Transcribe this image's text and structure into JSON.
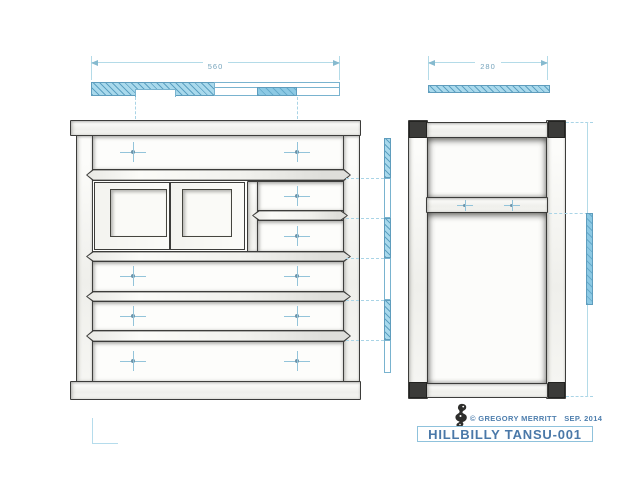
{
  "drawing": {
    "sheet_name": "tansu-plan-sheet",
    "title_block": {
      "title": "HILLBILLY TANSU-001",
      "copyright": "© GREGORY MERRITT   SEP. 2014",
      "stamp_icon": "maker-seal-stamp-icon"
    },
    "dimensions": {
      "front_width": "560",
      "side_depth": "280"
    },
    "views": {
      "front": "front-elevation",
      "side": "side-elevation",
      "plan": "top-section-plan"
    },
    "colors": {
      "paper": "#ffffff",
      "pencil_line": "#3c3c3a",
      "hatch_blue": "#a9d9ec",
      "solid_blue": "#8cc9e4",
      "annotation_blue": "#a9d4e6",
      "dim_text_blue": "#76a4bc",
      "title_text_blue": "#4a78a8"
    }
  }
}
